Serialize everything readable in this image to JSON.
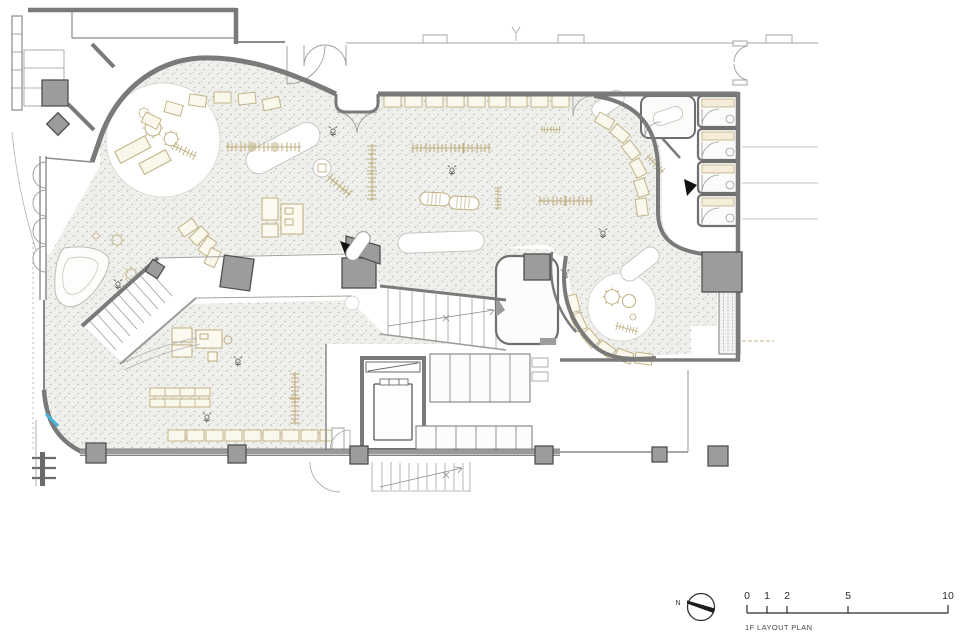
{
  "caption": {
    "text": "1F LAYOUT PLAN"
  },
  "north_arrow": {
    "label": "N"
  },
  "scale_bar": {
    "labels": [
      "0",
      "1",
      "2",
      "5",
      "10"
    ]
  },
  "colors": {
    "background": "#ffffff",
    "wall": "#7a7a7a",
    "wall_dark": "#4f4f4f",
    "column_fill": "#9c9c9c",
    "floor": "#efefec",
    "stipple_dot": "#b4b4aa",
    "furniture_beige": "#bfae7e",
    "accent_cyan": "#3fb9d9",
    "ink": "#2b2b2b"
  }
}
